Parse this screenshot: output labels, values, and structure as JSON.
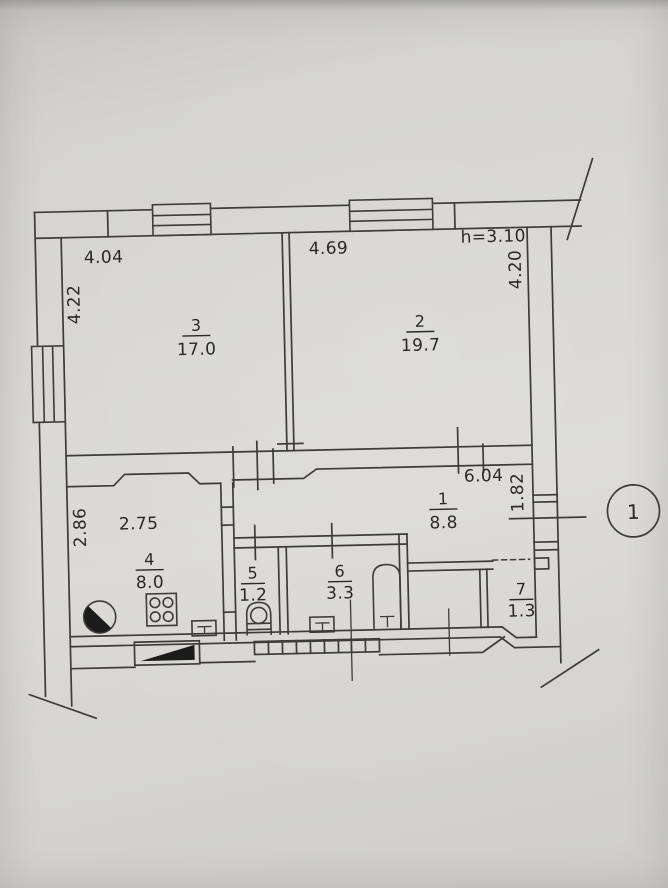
{
  "document": {
    "kind": "apartment floor plan (scanned technical inventory drawing)",
    "section_marker": "1",
    "rooms": [
      {
        "number": "1",
        "area": "8.8"
      },
      {
        "number": "2",
        "area": "19.7"
      },
      {
        "number": "3",
        "area": "17.0"
      },
      {
        "number": "4",
        "area": "8.0"
      },
      {
        "number": "5",
        "area": "1.2"
      },
      {
        "number": "6",
        "area": "3.3"
      },
      {
        "number": "7",
        "area": "1.3"
      }
    ],
    "dimensions": {
      "room3_width": "4.04",
      "room3_depth": "4.22",
      "room2_width": "4.69",
      "room2_depth": "4.20",
      "ceiling_height": "h=3.10",
      "hall_length": "6.04",
      "hall_depth": "1.82",
      "kitchen_depth": "2.86",
      "kitchen_width": "2.75"
    },
    "colors": {
      "paper": "#d8d7d3",
      "ink": "#3d3c3a",
      "text": "#2a2927",
      "solid_fill": "#1c1c1c"
    }
  }
}
